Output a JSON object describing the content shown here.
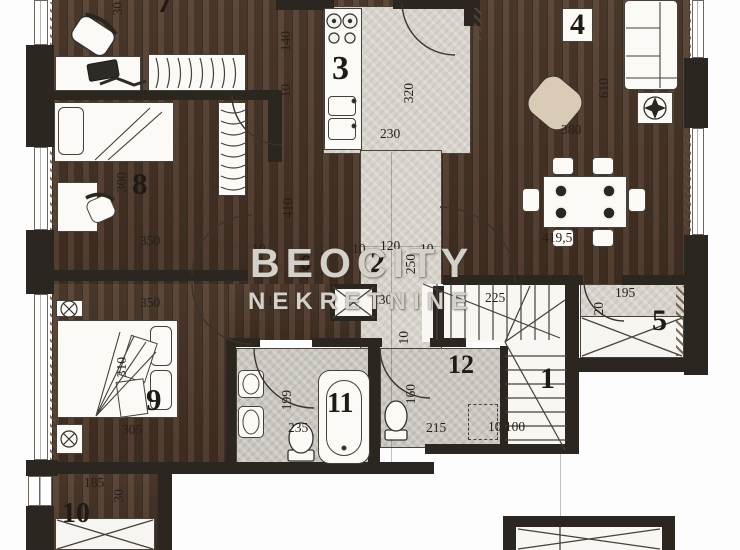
{
  "watermark": {
    "line1": "BEOCITY",
    "line2": "NEKRETNINE"
  },
  "plan": {
    "type": "apartment-floor-plan",
    "colors": {
      "wood": "#4a3527",
      "tile": "#d7d3cc",
      "bath_tile": "#c9c5bf",
      "wall": "#2b2620",
      "white": "#f8f7f4",
      "line": "#3a332c"
    },
    "rooms": [
      {
        "n": "7",
        "x": 156,
        "y": -18,
        "fs": 36
      },
      {
        "n": "3",
        "x": 332,
        "y": 52,
        "fs": 34
      },
      {
        "n": "4",
        "x": 562,
        "y": 8,
        "fs": 30,
        "box": true
      },
      {
        "n": "8",
        "x": 132,
        "y": 168,
        "fs": 31
      },
      {
        "n": "6",
        "x": 300,
        "y": 252,
        "fs": 22
      },
      {
        "n": "2",
        "x": 370,
        "y": 248,
        "fs": 30
      },
      {
        "n": "9",
        "x": 146,
        "y": 384,
        "fs": 31
      },
      {
        "n": "11",
        "x": 327,
        "y": 390,
        "fs": 28
      },
      {
        "n": "12",
        "x": 448,
        "y": 352,
        "fs": 26
      },
      {
        "n": "1",
        "x": 540,
        "y": 364,
        "fs": 30
      },
      {
        "n": "5",
        "x": 652,
        "y": 306,
        "fs": 30
      },
      {
        "n": "10",
        "x": 62,
        "y": 500,
        "fs": 28
      }
    ],
    "dims": [
      {
        "t": "30",
        "x": 111,
        "y": 2,
        "r": 1
      },
      {
        "t": "140",
        "x": 279,
        "y": 31,
        "r": 1
      },
      {
        "t": "10",
        "x": 279,
        "y": 84,
        "r": 1
      },
      {
        "t": "230",
        "x": 380,
        "y": 127
      },
      {
        "t": "320",
        "x": 402,
        "y": 83,
        "r": 1
      },
      {
        "t": "610",
        "x": 597,
        "y": 78,
        "r": 1
      },
      {
        "t": "380",
        "x": 561,
        "y": 123
      },
      {
        "t": "410",
        "x": 281,
        "y": 198,
        "r": 1
      },
      {
        "t": "10",
        "x": 252,
        "y": 242
      },
      {
        "t": "10",
        "x": 352,
        "y": 242
      },
      {
        "t": "120",
        "x": 380,
        "y": 239
      },
      {
        "t": "10",
        "x": 420,
        "y": 242
      },
      {
        "t": "250",
        "x": 404,
        "y": 254,
        "r": 1
      },
      {
        "t": "350",
        "x": 140,
        "y": 234
      },
      {
        "t": "300",
        "x": 115,
        "y": 172,
        "r": 1
      },
      {
        "t": "350",
        "x": 140,
        "y": 296
      },
      {
        "t": "10 10",
        "x": 250,
        "y": 294
      },
      {
        "t": "130",
        "x": 372,
        "y": 293
      },
      {
        "t": "419,5",
        "x": 542,
        "y": 231
      },
      {
        "t": "225",
        "x": 485,
        "y": 291
      },
      {
        "t": "195",
        "x": 615,
        "y": 286
      },
      {
        "t": "20",
        "x": 592,
        "y": 302,
        "r": 1
      },
      {
        "t": "199",
        "x": 280,
        "y": 390,
        "r": 1
      },
      {
        "t": "235",
        "x": 288,
        "y": 421
      },
      {
        "t": "160",
        "x": 404,
        "y": 384,
        "r": 1
      },
      {
        "t": "10",
        "x": 397,
        "y": 331,
        "r": 1
      },
      {
        "t": "215",
        "x": 426,
        "y": 421
      },
      {
        "t": "10 100",
        "x": 488,
        "y": 420
      },
      {
        "t": "310",
        "x": 115,
        "y": 357,
        "r": 1
      },
      {
        "t": "305",
        "x": 122,
        "y": 423
      },
      {
        "t": "185",
        "x": 84,
        "y": 476
      },
      {
        "t": "30",
        "x": 112,
        "y": 489,
        "r": 1
      }
    ]
  }
}
